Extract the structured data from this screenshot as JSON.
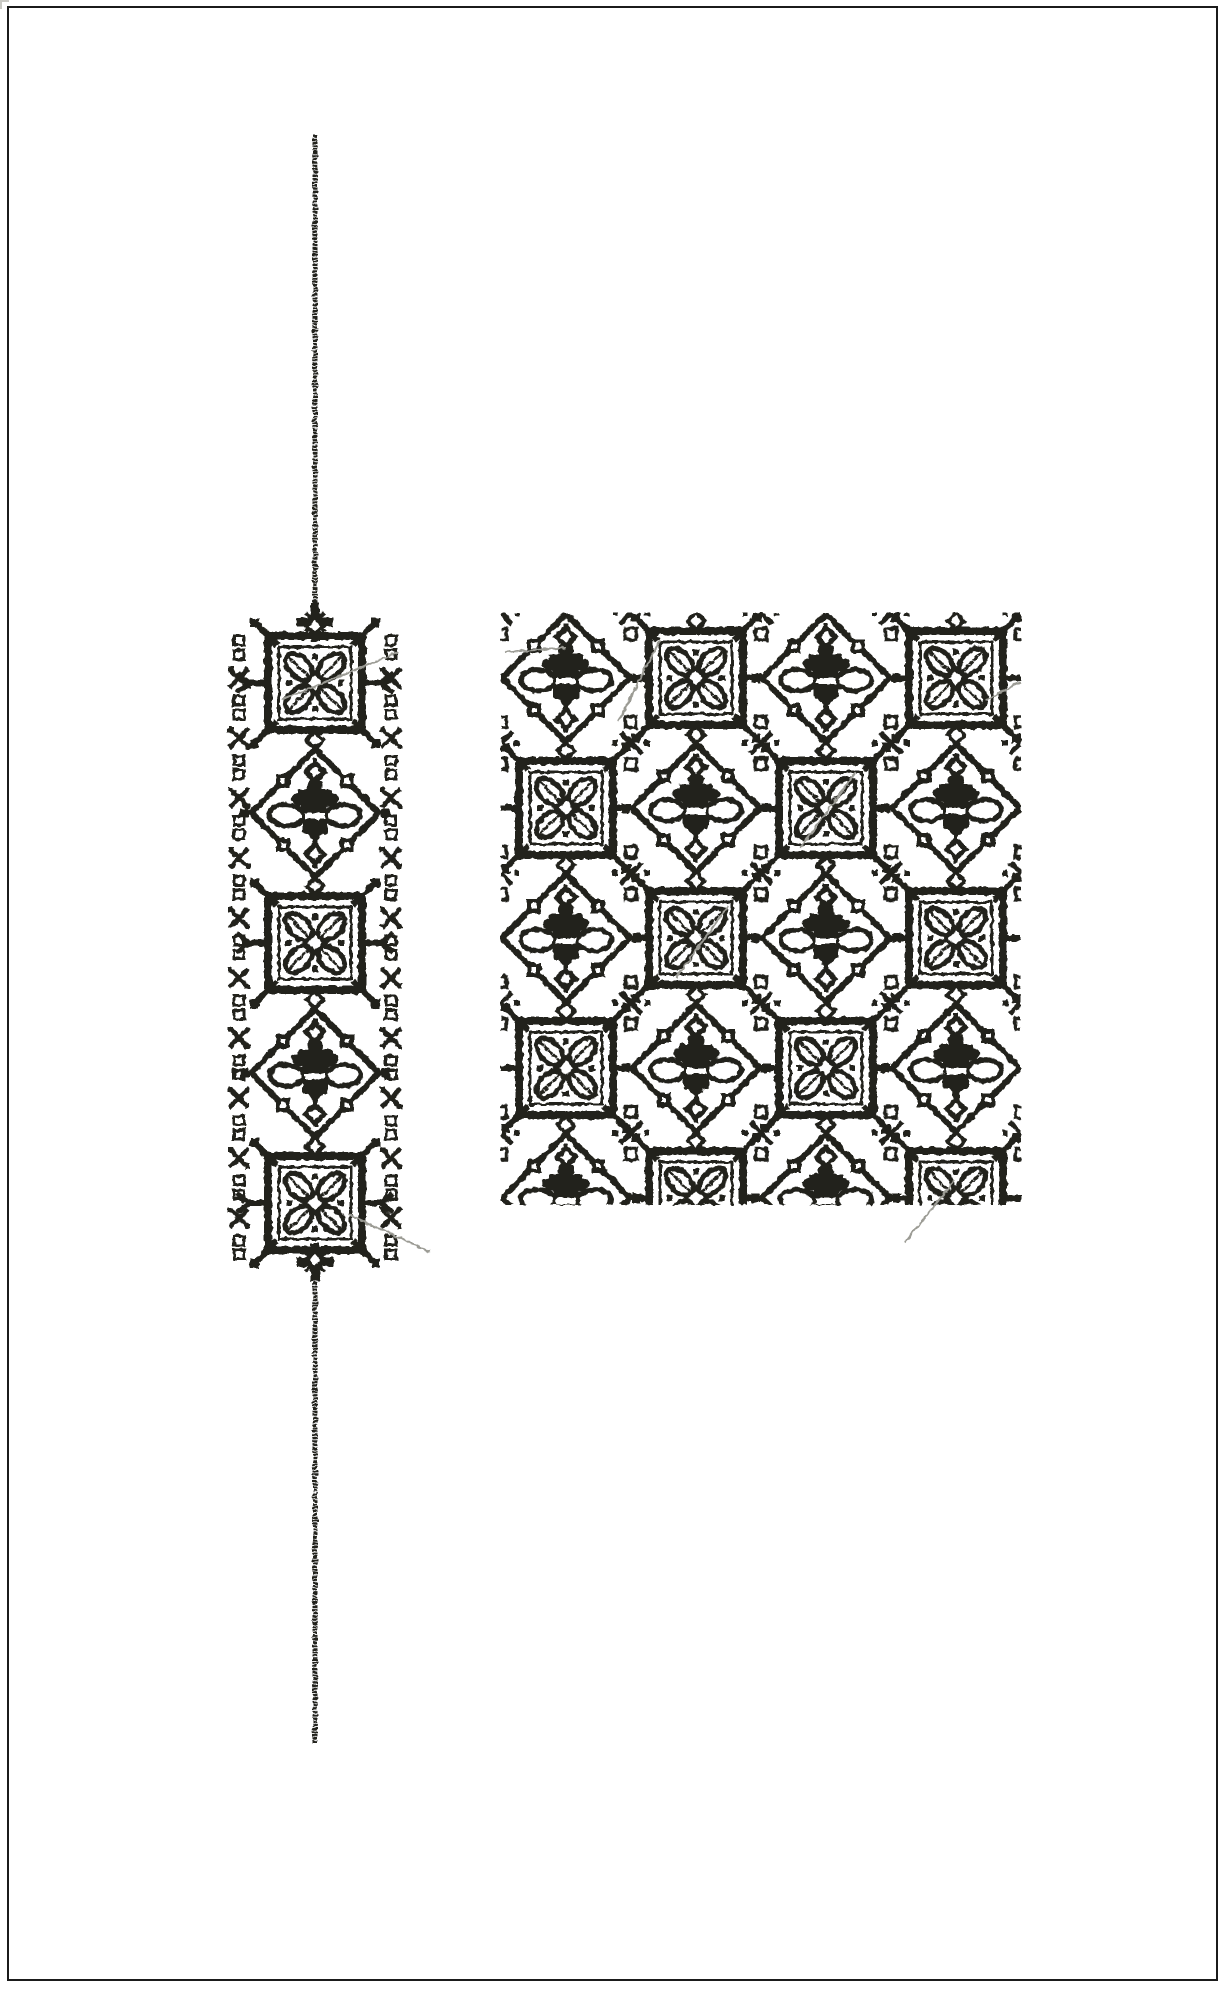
{
  "document": {
    "kind_label": "stitch-pattern-proof-page",
    "background_color": "#ffffff",
    "page_border_color": "#1b1b1b"
  },
  "colors": {
    "stitch": "#24241f",
    "jump_stitch": "#9b9b94",
    "white": "#ffffff"
  },
  "band": {
    "motif_sequence": [
      "flower",
      "bee",
      "flower",
      "bee",
      "flower"
    ],
    "center_x": 315,
    "first_motif_y": 683,
    "motif_spacing": 130,
    "edge_column_offsets": [
      -76,
      76
    ],
    "edge_marks_start_y": 648,
    "edge_marks_end_y": 1248,
    "edge_marks_step": 30,
    "terminal_top_y": 622,
    "terminal_bottom_y": 1262
  },
  "satin_lines": {
    "top": {
      "x": 315,
      "y1": 135,
      "y2": 610,
      "width": 5
    },
    "bottom": {
      "x": 315,
      "y1": 1272,
      "y2": 1743,
      "width": 5
    }
  },
  "swatch": {
    "x": 501,
    "y": 613,
    "width": 520,
    "height": 592,
    "tile_size": 130,
    "columns": 4,
    "rows": 5,
    "checkerboard": [
      "bee",
      "flower"
    ]
  },
  "jump_stitches": [
    [
      282,
      700,
      398,
      652
    ],
    [
      505,
      652,
      566,
      648
    ],
    [
      618,
      722,
      660,
      640
    ],
    [
      800,
      848,
      856,
      772
    ],
    [
      676,
      978,
      728,
      906
    ],
    [
      986,
      700,
      1020,
      682
    ],
    [
      348,
      1214,
      430,
      1252
    ],
    [
      905,
      1242,
      955,
      1180
    ]
  ]
}
